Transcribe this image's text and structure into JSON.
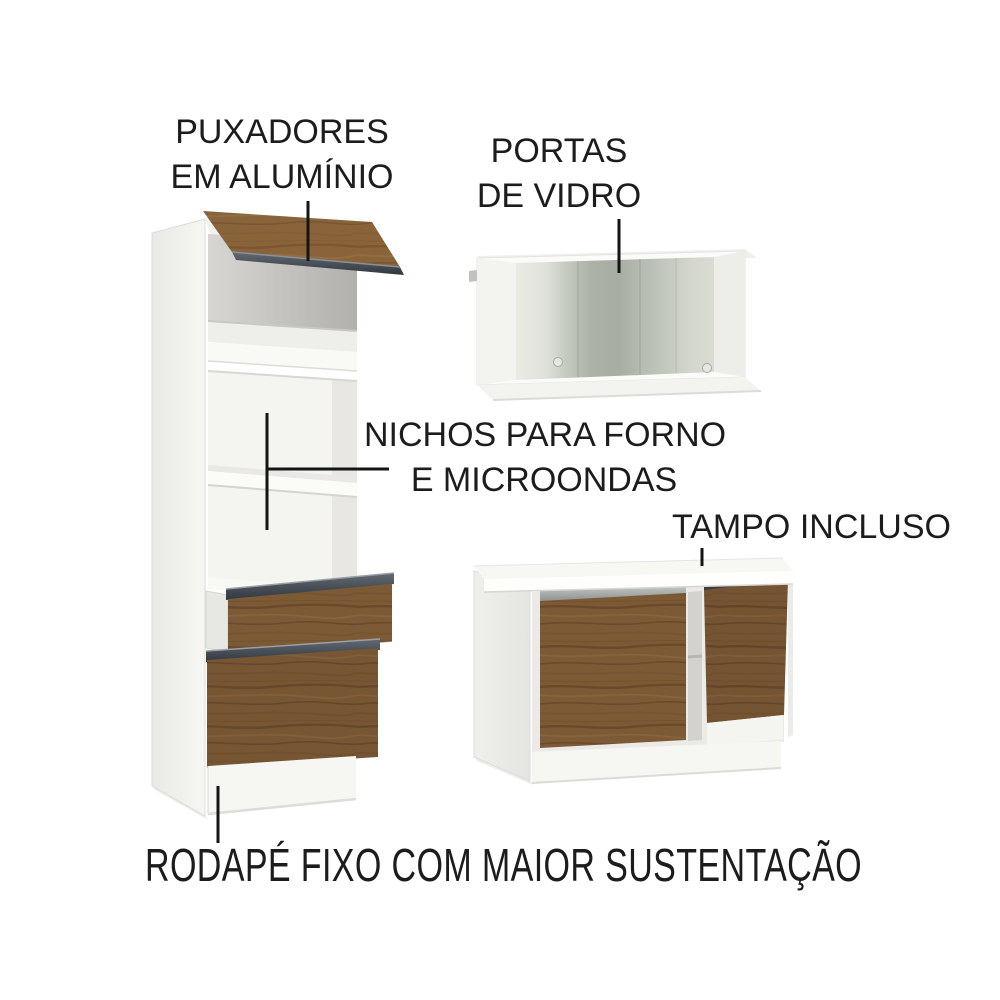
{
  "annotations": {
    "handles": {
      "line1": "PUXADORES",
      "line2": "EM ALUMÍNIO"
    },
    "glass_doors": {
      "line1": "PORTAS",
      "line2": "DE VIDRO"
    },
    "niches": {
      "line1": "NICHOS PARA FORNO",
      "line2": "E MICROONDAS"
    },
    "countertop": {
      "text": "TAMPO INCLUSO"
    },
    "baseboard": {
      "text": "RODAPÉ FIXO COM MAIOR SUSTENTAÇÃO"
    }
  },
  "scene": {
    "pieces": [
      "tall-oven-tower-cabinet",
      "wall-cabinet-with-glass-doors",
      "base-cabinet-with-countertop"
    ],
    "style": "3d-product-render-on-white"
  },
  "colors": {
    "background": "#ffffff",
    "text": "#1c1c1c",
    "pointer_line": "#141414",
    "wood": "#7c5a36",
    "wood_grain_dark": "#5d4023",
    "aluminum_dark": "#454b53",
    "aluminum_silver": "#b6bbb9",
    "cabinet_white": "#f8f8f5",
    "interior_gray": "#c3c1bd",
    "glass": "#b3b9ae"
  }
}
